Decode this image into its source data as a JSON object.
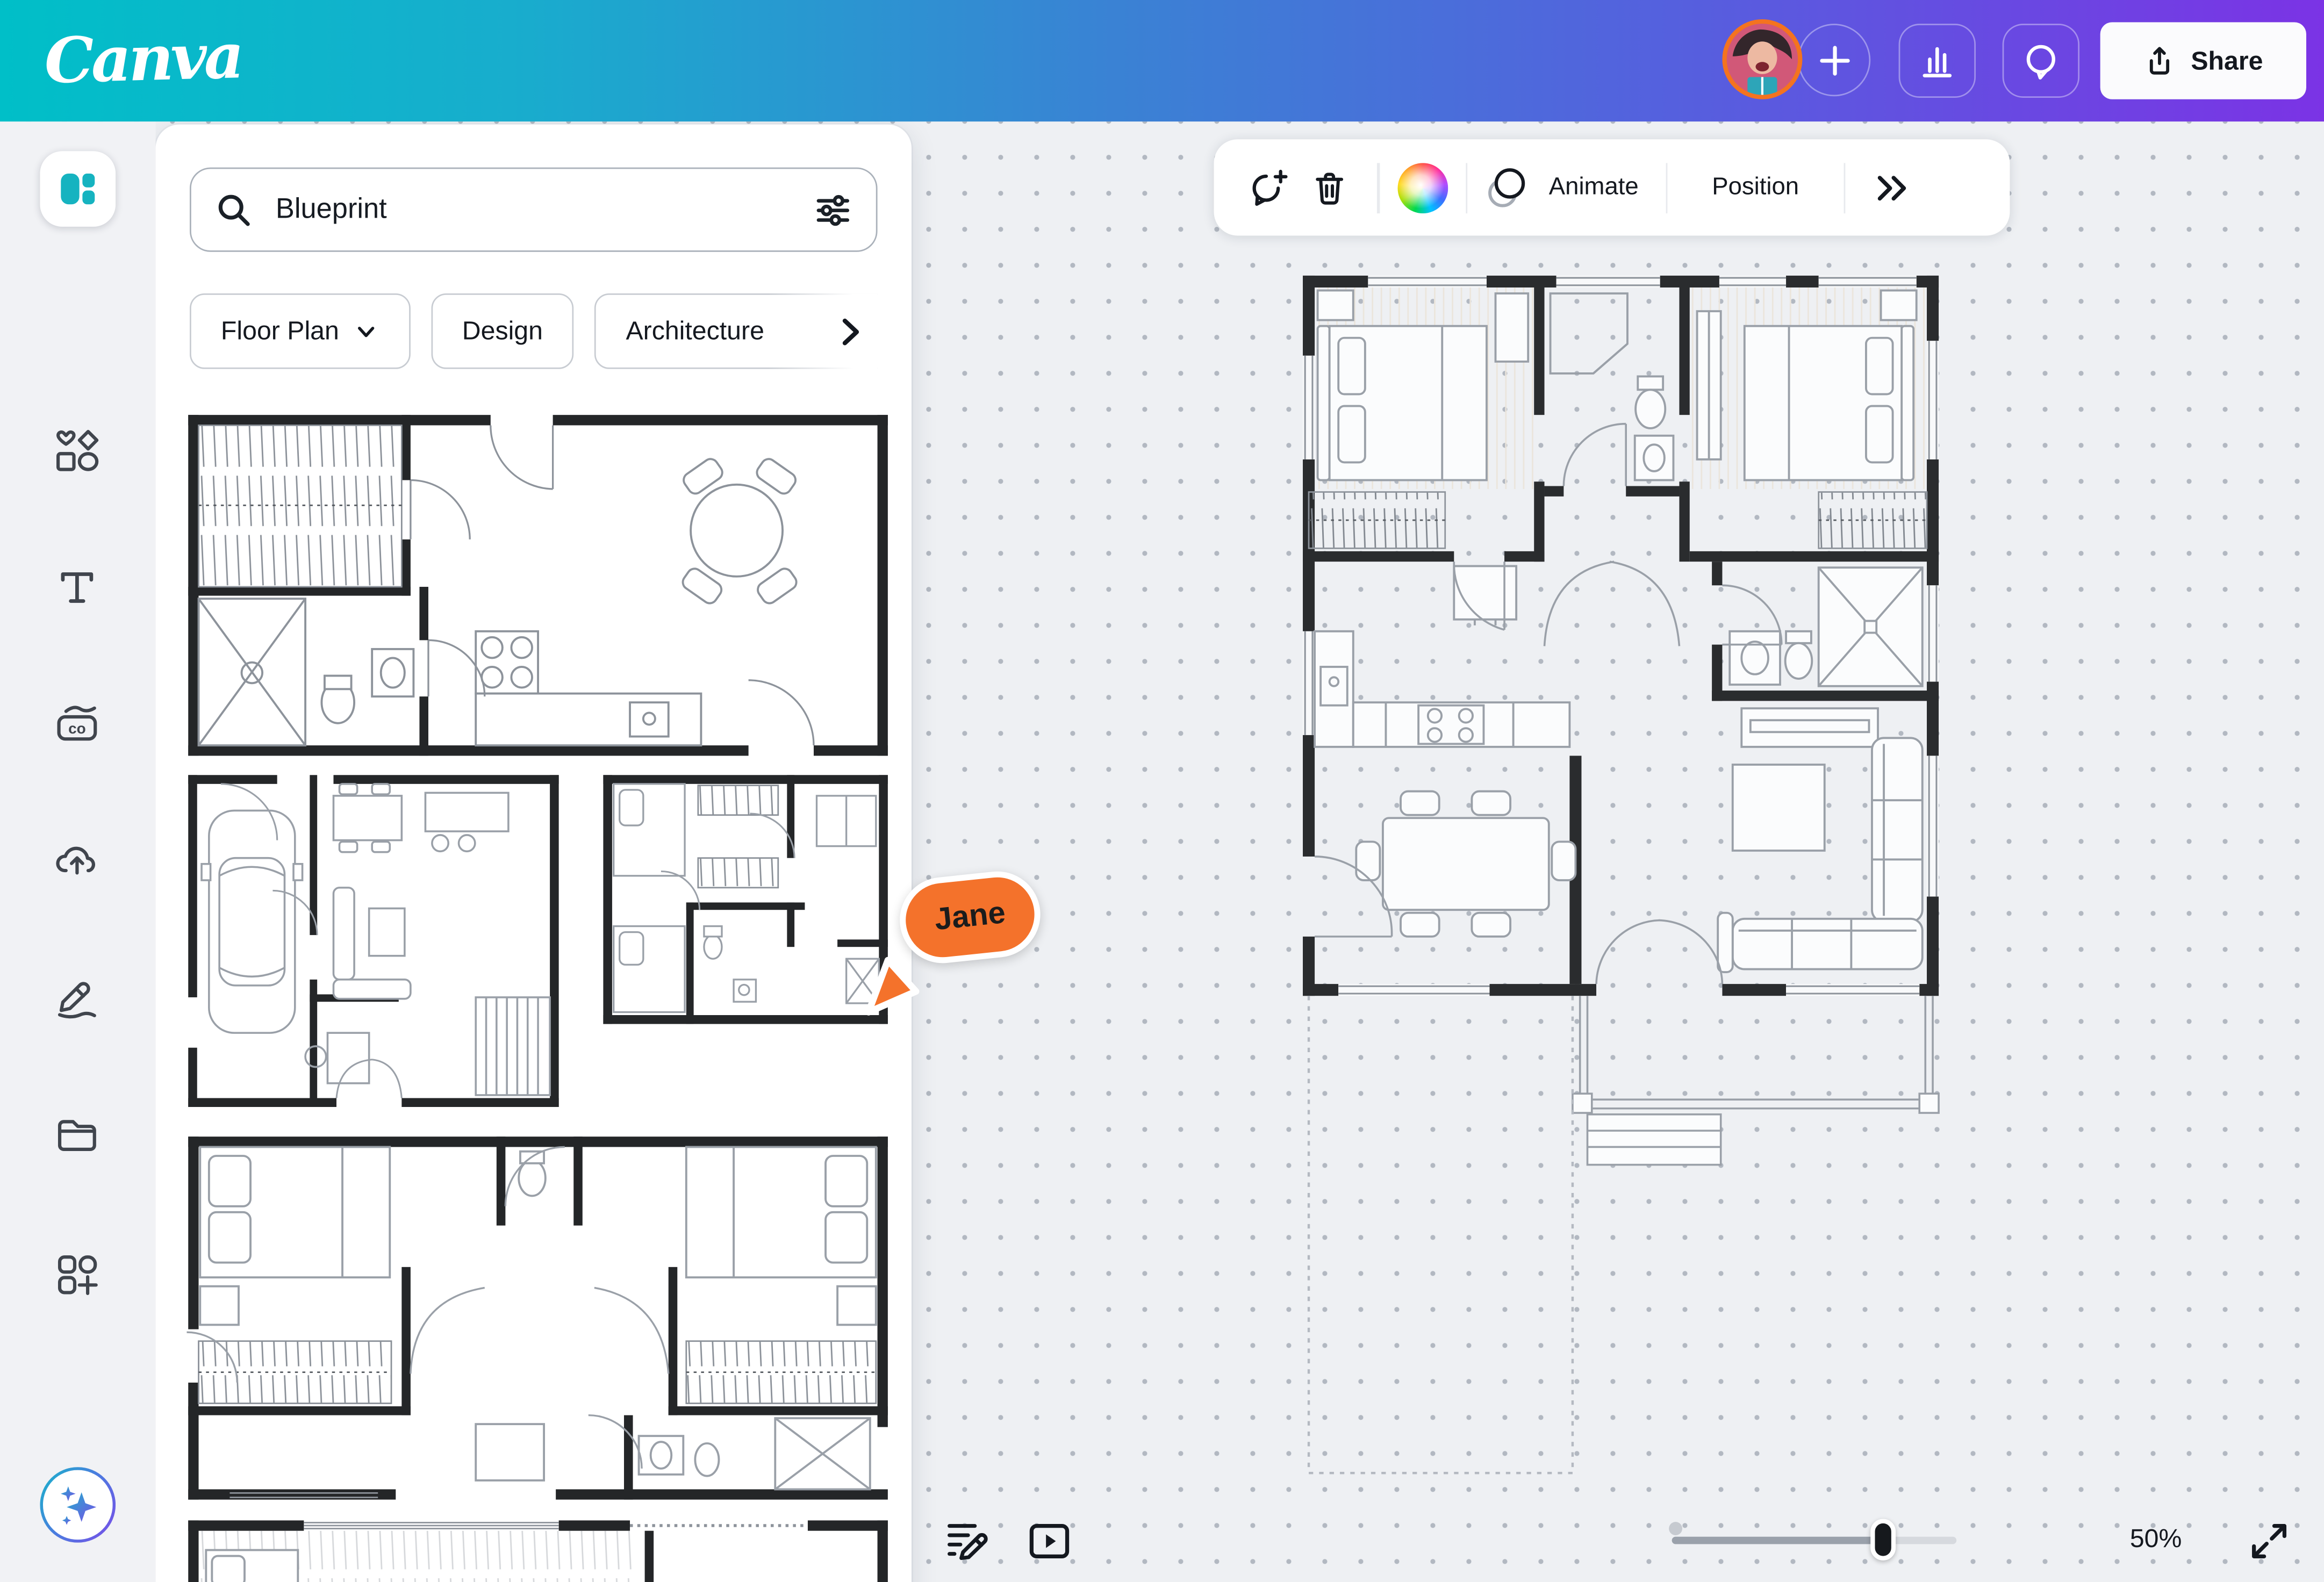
{
  "topbar": {
    "logo": "Canva",
    "share_label": "Share",
    "actions": [
      "avatar",
      "add-new",
      "insights",
      "comments",
      "share"
    ],
    "gradient": [
      "#00BFC8",
      "#3A82D4",
      "#7B33E5"
    ]
  },
  "sidebar": {
    "items": [
      {
        "id": "design",
        "icon": "design-icon",
        "active": true
      },
      {
        "id": "elements",
        "icon": "elements-shapes-icon"
      },
      {
        "id": "text",
        "icon": "text-icon"
      },
      {
        "id": "brand",
        "icon": "brand-icon"
      },
      {
        "id": "uploads",
        "icon": "cloud-upload-icon"
      },
      {
        "id": "draw",
        "icon": "draw-pen-icon"
      },
      {
        "id": "projects",
        "icon": "folder-icon"
      },
      {
        "id": "apps",
        "icon": "apps-grid-icon"
      },
      {
        "id": "magic",
        "icon": "magic-sparkles-icon"
      }
    ]
  },
  "panel": {
    "search": {
      "value": "Blueprint",
      "icon": "search-icon",
      "trailing_icon": "filter-sliders-icon"
    },
    "chips": [
      {
        "label": "Floor Plan",
        "trailing_icon": "chevron-down-icon"
      },
      {
        "label": "Design"
      },
      {
        "label": "Architecture",
        "trailing_icon": "chevron-right-icon"
      }
    ],
    "results": [
      {
        "name": "floor-plan-studio-thumbnail"
      },
      {
        "name": "floor-plan-garage-house-thumbnail"
      },
      {
        "name": "floor-plan-apartment-thumbnail"
      },
      {
        "name": "floor-plan-two-bedroom-thumbnail"
      },
      {
        "name": "floor-plan-partial-thumbnail"
      }
    ]
  },
  "canvas_toolbar": {
    "icons": [
      "comment-add",
      "delete",
      "color-picker",
      "animate",
      "position",
      "more"
    ],
    "animate_label": "Animate",
    "position_label": "Position"
  },
  "collaborator": {
    "name": "Jane",
    "color": "#F4722B"
  },
  "canvas": {
    "content": "house floor plan blueprint with porch and driveway"
  },
  "footer": {
    "zoom_label": "50%",
    "slider_percent": 73,
    "icons": [
      "notes",
      "present",
      "zoom-slider",
      "fullscreen"
    ]
  }
}
